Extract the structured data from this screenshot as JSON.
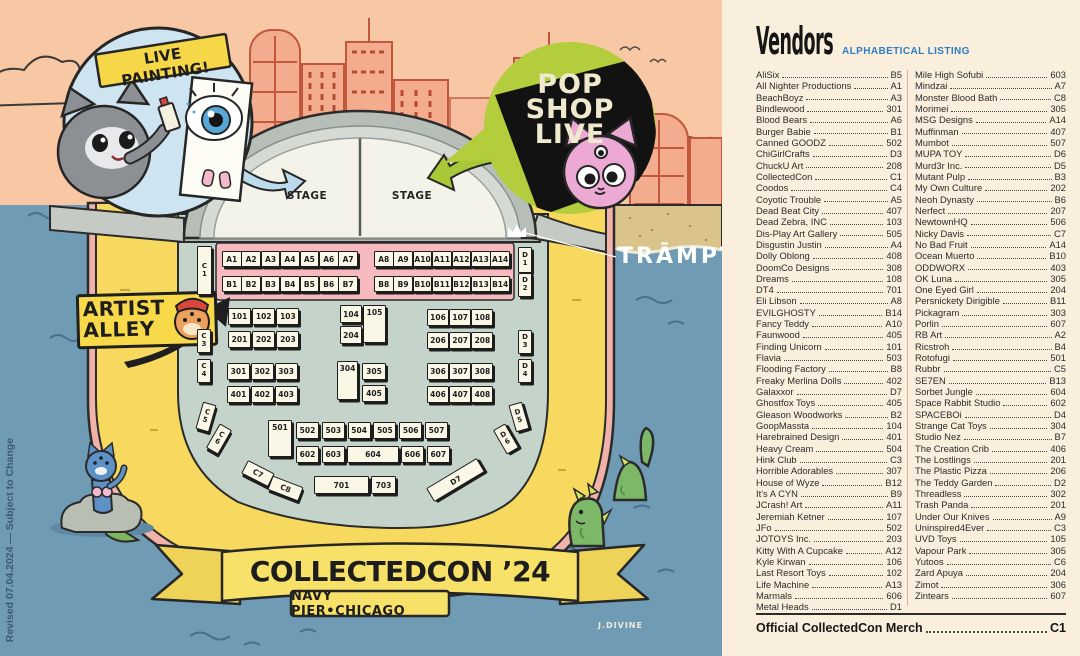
{
  "map": {
    "live_painting": "LIVE PAINTING!",
    "pop_lines": [
      "POP",
      "SHOP",
      "LIVE"
    ],
    "stage_left": "STAGE",
    "stage_right": "STAGE",
    "artist_line1": "ARTIST",
    "artist_line2": "ALLEY",
    "trampt": "TRĀMPT",
    "banner_title": "COLLECTEDCON ’24",
    "banner_subtitle": "NAVY PIER•CHICAGO",
    "signature": "J.DIVINE",
    "revision": "Revised 07.04.2024 — Subject to Change",
    "booths": {
      "a_left": [
        "A1",
        "A2",
        "A3",
        "A4",
        "A5",
        "A6",
        "A7"
      ],
      "a_right": [
        "A8",
        "A9",
        "A10",
        "A11",
        "A12",
        "A13",
        "A14"
      ],
      "b_left": [
        "B1",
        "B2",
        "B3",
        "B4",
        "B5",
        "B6",
        "B7"
      ],
      "b_right": [
        "B8",
        "B9",
        "B10",
        "B11",
        "B12",
        "B13",
        "B14"
      ],
      "r100": [
        "101",
        "102",
        "103"
      ],
      "r100r": [
        "106",
        "107",
        "108"
      ],
      "r200": [
        "201",
        "202",
        "203"
      ],
      "r200r": [
        "206",
        "207",
        "208"
      ],
      "r300": [
        "301",
        "302",
        "303"
      ],
      "r300r": [
        "306",
        "307",
        "308"
      ],
      "r400": [
        "401",
        "402",
        "403"
      ],
      "r400r": [
        "406",
        "407",
        "408"
      ],
      "m104": "104",
      "m105": "105",
      "m204": "204",
      "m304": "304",
      "m305": "305",
      "m405": "405",
      "m501": "501",
      "r500": [
        "502",
        "503",
        "504",
        "505",
        "506",
        "507"
      ],
      "r600": [
        "602",
        "603"
      ],
      "m604": "604",
      "r600b": [
        "606",
        "607"
      ],
      "m701": "701",
      "m703": "703",
      "c1": "C1",
      "c3": "C3",
      "c4": "C4",
      "c5": "C5",
      "c6": "C6",
      "c7": "C7",
      "c8": "C8",
      "d1": "D1",
      "d2": "D2",
      "d3": "D3",
      "d4": "D4",
      "d5": "D5",
      "d6": "D6",
      "d7": "D7"
    }
  },
  "vendors": {
    "title": "Vendors",
    "subtitle": "ALPHABETICAL LISTING",
    "left": [
      [
        "AliSix",
        "B5"
      ],
      [
        "All Nighter Productions",
        "A1"
      ],
      [
        "BeachBoyz",
        "A3"
      ],
      [
        "Bindlewood",
        "301"
      ],
      [
        "Blood Bears",
        "A6"
      ],
      [
        "Burger Babie",
        "B1"
      ],
      [
        "Canned GOODZ",
        "502"
      ],
      [
        "ChiGirlCrafts",
        "D3"
      ],
      [
        "ChuckU Art",
        "208"
      ],
      [
        "CollectedCon",
        "C1"
      ],
      [
        "Coodos",
        "C4"
      ],
      [
        "Coyotic Trouble",
        "A5"
      ],
      [
        "Dead Beat City",
        "407"
      ],
      [
        "Dead Zebra, INC",
        "103"
      ],
      [
        "Dis-Play Art Gallery",
        "505"
      ],
      [
        "Disgustin Justin",
        "A4"
      ],
      [
        "Dolly Oblong",
        "408"
      ],
      [
        "DoomCo Designs",
        "308"
      ],
      [
        "Dreams",
        "108"
      ],
      [
        "DT4",
        "701"
      ],
      [
        "Eli Libson",
        "A8"
      ],
      [
        "EVILGHOSTY",
        "B14"
      ],
      [
        "Fancy Teddy",
        "A10"
      ],
      [
        "Faunwood",
        "405"
      ],
      [
        "Finding Unicorn",
        "101"
      ],
      [
        "Flavia",
        "503"
      ],
      [
        "Flooding Factory",
        "B8"
      ],
      [
        "Freaky Merlina Dolls",
        "402"
      ],
      [
        "Galaxxor",
        "D7"
      ],
      [
        "Ghostfox Toys",
        "405"
      ],
      [
        "Gleason Woodworks",
        "B2"
      ],
      [
        "GoopMassta",
        "104"
      ],
      [
        "Harebrained Design",
        "401"
      ],
      [
        "Heavy Cream",
        "504"
      ],
      [
        "Hink Club",
        "C3"
      ],
      [
        "Horrible Adorables",
        "307"
      ],
      [
        "House of Wyze",
        "B12"
      ],
      [
        "It's A CYN",
        "B9"
      ],
      [
        "JCrash! Art",
        "A11"
      ],
      [
        "Jeremiah Ketner",
        "107"
      ],
      [
        "JFo",
        "502"
      ],
      [
        "JOTOYS Inc.",
        "203"
      ],
      [
        "Kitty With A Cupcake",
        "A12"
      ],
      [
        "Kyle Kirwan",
        "106"
      ],
      [
        "Last Resort Toys",
        "102"
      ],
      [
        "Life Machine",
        "A13"
      ],
      [
        "Marmals",
        "606"
      ],
      [
        "Metal Heads",
        "D1"
      ]
    ],
    "right": [
      [
        "Mile High Sofubi",
        "603"
      ],
      [
        "Mindzai",
        "A7"
      ],
      [
        "Monster Blood Bath",
        "C8"
      ],
      [
        "Morimei",
        "305"
      ],
      [
        "MSG Designs",
        "A14"
      ],
      [
        "Muffinman",
        "407"
      ],
      [
        "Mumbot",
        "507"
      ],
      [
        "MUPA TOY",
        "D6"
      ],
      [
        "Murd3r Inc.",
        "D5"
      ],
      [
        "Mutant Pulp",
        "B3"
      ],
      [
        "My Own Culture",
        "202"
      ],
      [
        "Neoh Dynasty",
        "B6"
      ],
      [
        "Nerfect",
        "207"
      ],
      [
        "NewtownHQ",
        "506"
      ],
      [
        "Nicky Davis",
        "C7"
      ],
      [
        "No Bad Fruit",
        "A14"
      ],
      [
        "Ocean Muerto",
        "B10"
      ],
      [
        "ODDWORX",
        "403"
      ],
      [
        "OK Luna",
        "305"
      ],
      [
        "One Eyed Girl",
        "204"
      ],
      [
        "Persnickety Dirigible",
        "B11"
      ],
      [
        "Pickagram",
        "303"
      ],
      [
        "Porlin",
        "607"
      ],
      [
        "RB Art",
        "A2"
      ],
      [
        "Ricstroh",
        "B4"
      ],
      [
        "Rotofugi",
        "501"
      ],
      [
        "Rubbr",
        "C5"
      ],
      [
        "SE7EN",
        "B13"
      ],
      [
        "Sorbet Jungle",
        "604"
      ],
      [
        "Space Rabbit Studio",
        "602"
      ],
      [
        "SPACEBOi",
        "D4"
      ],
      [
        "Strange Cat Toys",
        "304"
      ],
      [
        "Studio Nez",
        "B7"
      ],
      [
        "The Creation Crib",
        "406"
      ],
      [
        "The Lostlings",
        "201"
      ],
      [
        "The Plastic Pizza",
        "206"
      ],
      [
        "The Teddy Garden",
        "D2"
      ],
      [
        "Threadless",
        "302"
      ],
      [
        "Trash Panda",
        "201"
      ],
      [
        "Under Our Knives",
        "A9"
      ],
      [
        "Uninspired4Ever",
        "C3"
      ],
      [
        "UVD Toys",
        "105"
      ],
      [
        "Vapour Park",
        "305"
      ],
      [
        "Yutoos",
        "C6"
      ],
      [
        "Zard Apuya",
        "204"
      ],
      [
        "Zimot",
        "306"
      ],
      [
        "Zintears",
        "607"
      ]
    ],
    "footer": {
      "name": "Official CollectedCon Merch",
      "booth": "C1"
    }
  }
}
